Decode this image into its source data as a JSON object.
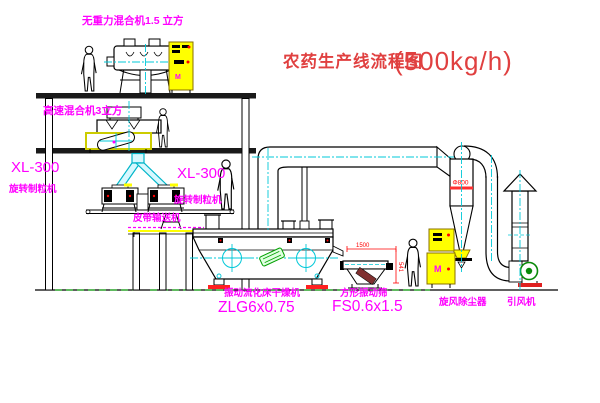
{
  "title": {
    "name": "农药生产线流程图",
    "capacity": "(500kg/h)"
  },
  "equipment_labels": {
    "top_mixer": "无重力混合机1.5 立方",
    "mid_mixer": "高速混合机3立方",
    "granulator_left_model": "XL-300",
    "granulator_left_name": "旋转制粒机",
    "granulator_right_model": "XL-300",
    "granulator_right_name": "旋转制粒机",
    "belt_conveyor": "皮带输送机",
    "dryer_name": "振动流化床干燥机",
    "dryer_model": "ZLG6x0.75",
    "screen_name": "方形振动筛",
    "screen_model": "FS0.6x1.5",
    "cyclone_name": "旋风除尘器",
    "fan_name": "引风机"
  },
  "dimensions": {
    "cyclone_diameter": "Φ800",
    "screen_length": "1500",
    "screen_height": "541"
  },
  "control_cabinet_mark": "M",
  "colors": {
    "label_magenta": "#ff00ff",
    "title_red": "#e04040",
    "centerline_cyan": "#00c8d8",
    "highlight_yellow": "#ffff00",
    "accent_red": "#ff0000",
    "machine_green": "#00a000",
    "line_black": "#000000",
    "background": "#ffffff"
  }
}
